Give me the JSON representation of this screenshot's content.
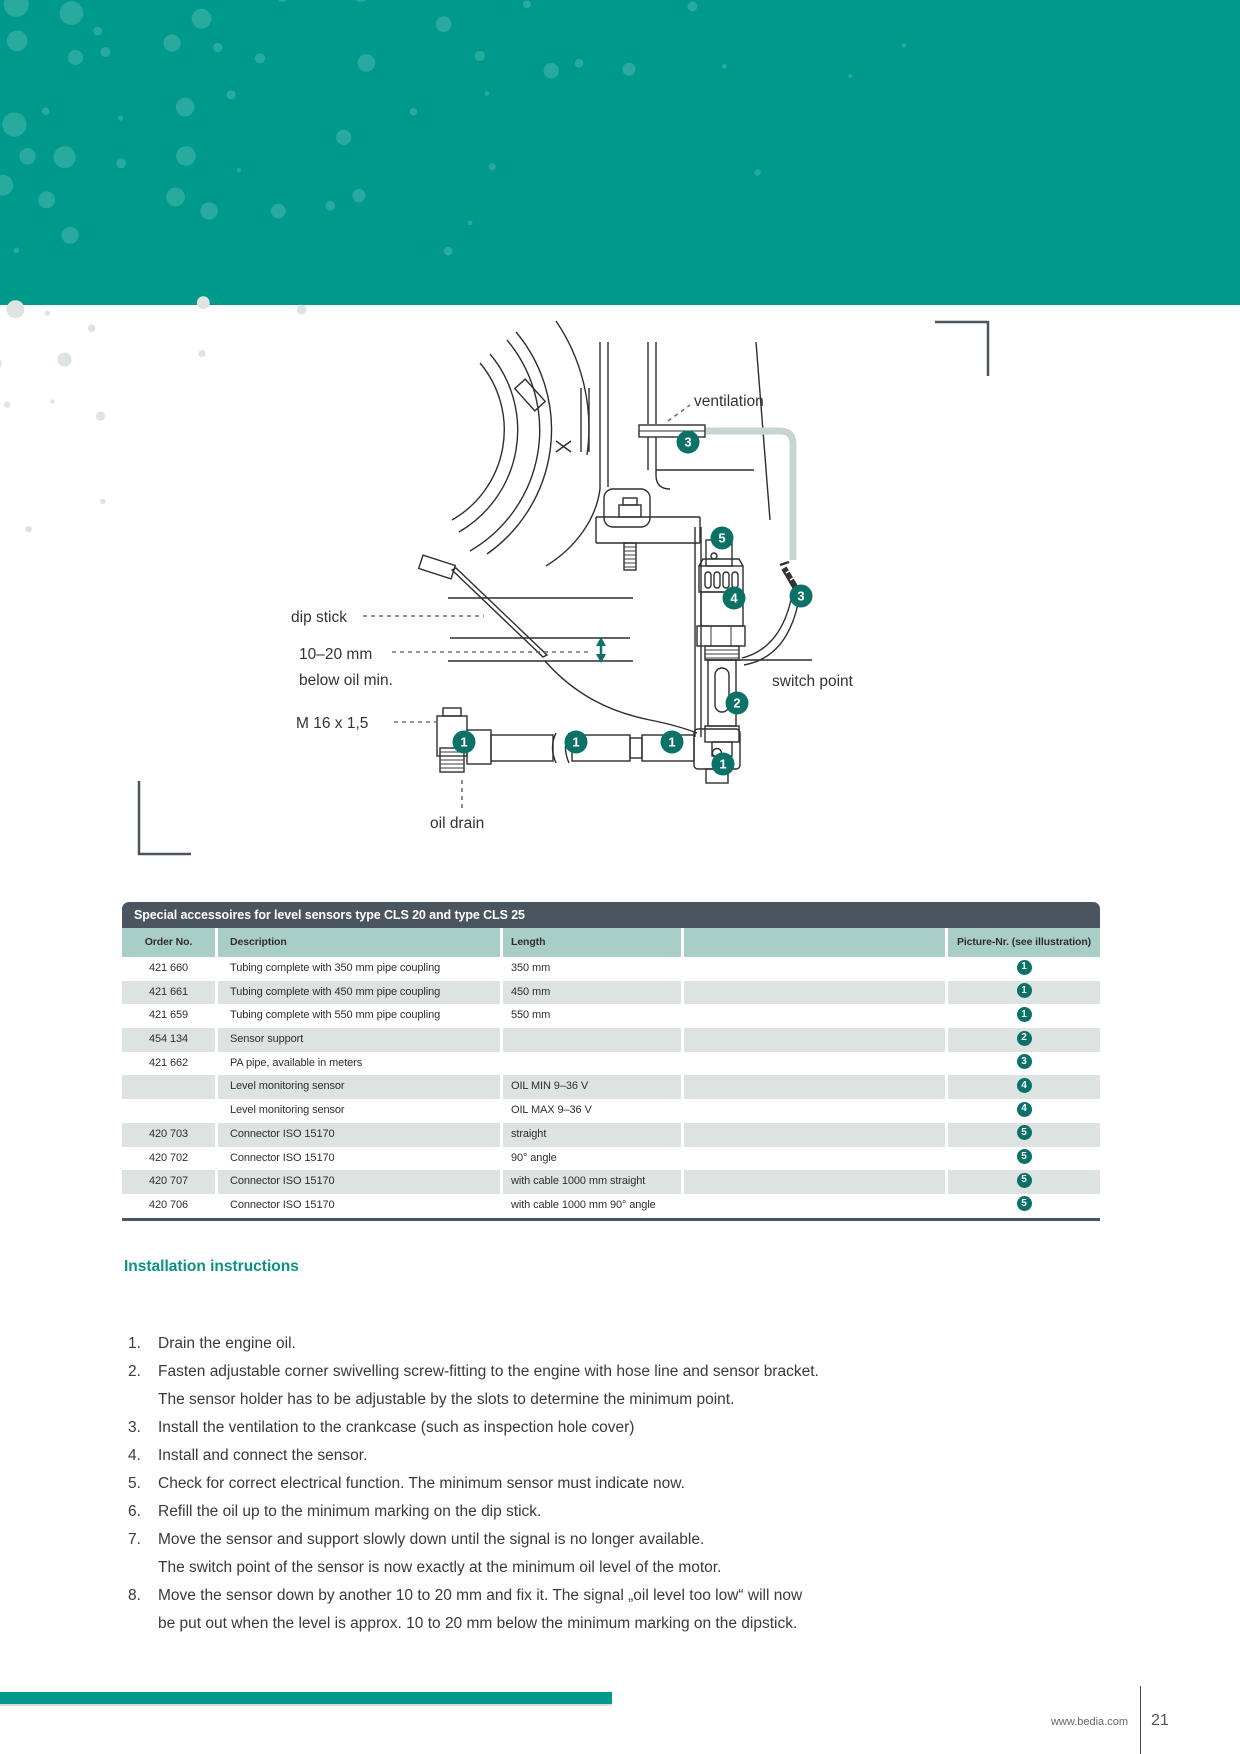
{
  "diagram": {
    "labels": {
      "ventilation": "ventilation",
      "dip_stick": "dip stick",
      "range": "10–20 mm",
      "below_oil_min": "below oil min.",
      "thread": "M 16 x 1,5",
      "switch_point": "switch point",
      "oil_drain": "oil drain"
    },
    "callouts": {
      "c1": "1",
      "c2": "2",
      "c3": "3",
      "c4": "4",
      "c5": "5"
    }
  },
  "table": {
    "title": "Special accessoires for level sensors type CLS 20 and type CLS 25",
    "columns": [
      "Order No.",
      "Description",
      "Length",
      "",
      "Picture-Nr. (see illustration)"
    ],
    "rows": [
      {
        "order_no": "421 660",
        "description": "Tubing complete with 350 mm pipe coupling",
        "length": "350 mm",
        "picture_nr": "1"
      },
      {
        "order_no": "421 661",
        "description": "Tubing complete with 450 mm pipe coupling",
        "length": "450 mm",
        "picture_nr": "1"
      },
      {
        "order_no": "421 659",
        "description": "Tubing complete with 550 mm pipe coupling",
        "length": "550 mm",
        "picture_nr": "1"
      },
      {
        "order_no": "454 134",
        "description": "Sensor support",
        "length": "",
        "picture_nr": "2"
      },
      {
        "order_no": "421 662",
        "description": "PA pipe, available in meters",
        "length": "",
        "picture_nr": "3"
      },
      {
        "order_no": "",
        "description": "Level monitoring sensor",
        "length": "OIL MIN 9–36 V",
        "picture_nr": "4"
      },
      {
        "order_no": "",
        "description": "Level monitoring sensor",
        "length": "OIL MAX 9–36 V",
        "picture_nr": "4"
      },
      {
        "order_no": "420 703",
        "description": "Connector ISO 15170",
        "length": "straight",
        "picture_nr": "5"
      },
      {
        "order_no": "420 702",
        "description": "Connector ISO 15170",
        "length": "90° angle",
        "picture_nr": "5"
      },
      {
        "order_no": "420 707",
        "description": "Connector ISO 15170",
        "length": "with cable 1000 mm straight",
        "picture_nr": "5"
      },
      {
        "order_no": "420 706",
        "description": "Connector ISO 15170",
        "length": "with cable 1000 mm 90° angle",
        "picture_nr": "5"
      }
    ]
  },
  "instructions": {
    "heading": "Installation instructions",
    "items": [
      {
        "number": "1.",
        "lines": [
          "Drain the engine oil."
        ]
      },
      {
        "number": "2.",
        "lines": [
          "Fasten adjustable corner swivelling screw-fitting to the engine with hose line and sensor bracket.",
          "The sensor holder has to be adjustable by the slots to determine the minimum point."
        ]
      },
      {
        "number": "3.",
        "lines": [
          "Install the ventilation to the crankcase (such as inspection hole cover)"
        ]
      },
      {
        "number": "4.",
        "lines": [
          "Install and connect the sensor."
        ]
      },
      {
        "number": "5.",
        "lines": [
          "Check for correct electrical function. The minimum sensor must indicate now."
        ]
      },
      {
        "number": "6.",
        "lines": [
          "Refill the oil up to the minimum marking on the dip stick."
        ]
      },
      {
        "number": "7.",
        "lines": [
          "Move the sensor and support slowly down until the signal is no longer available.",
          "The switch point of the sensor is now exactly at the minimum oil level of the motor."
        ]
      },
      {
        "number": "8.",
        "lines": [
          "Move the sensor down by another 10 to 20 mm and fix it. The signal „oil level too low“ will now",
          "be put out when the level is approx. 10 to 20 mm below the minimum marking on the dipstick."
        ]
      }
    ]
  },
  "footer": {
    "website": "www.bedia.com",
    "page_number": "21"
  },
  "colors": {
    "band_teal": "#009a8d",
    "callout_teal": "#0c7268",
    "table_title_bg": "#4b555f",
    "table_header_bg": "#a9cec8",
    "table_row_alt": "#dde3e1",
    "heading_teal": "#089384"
  }
}
